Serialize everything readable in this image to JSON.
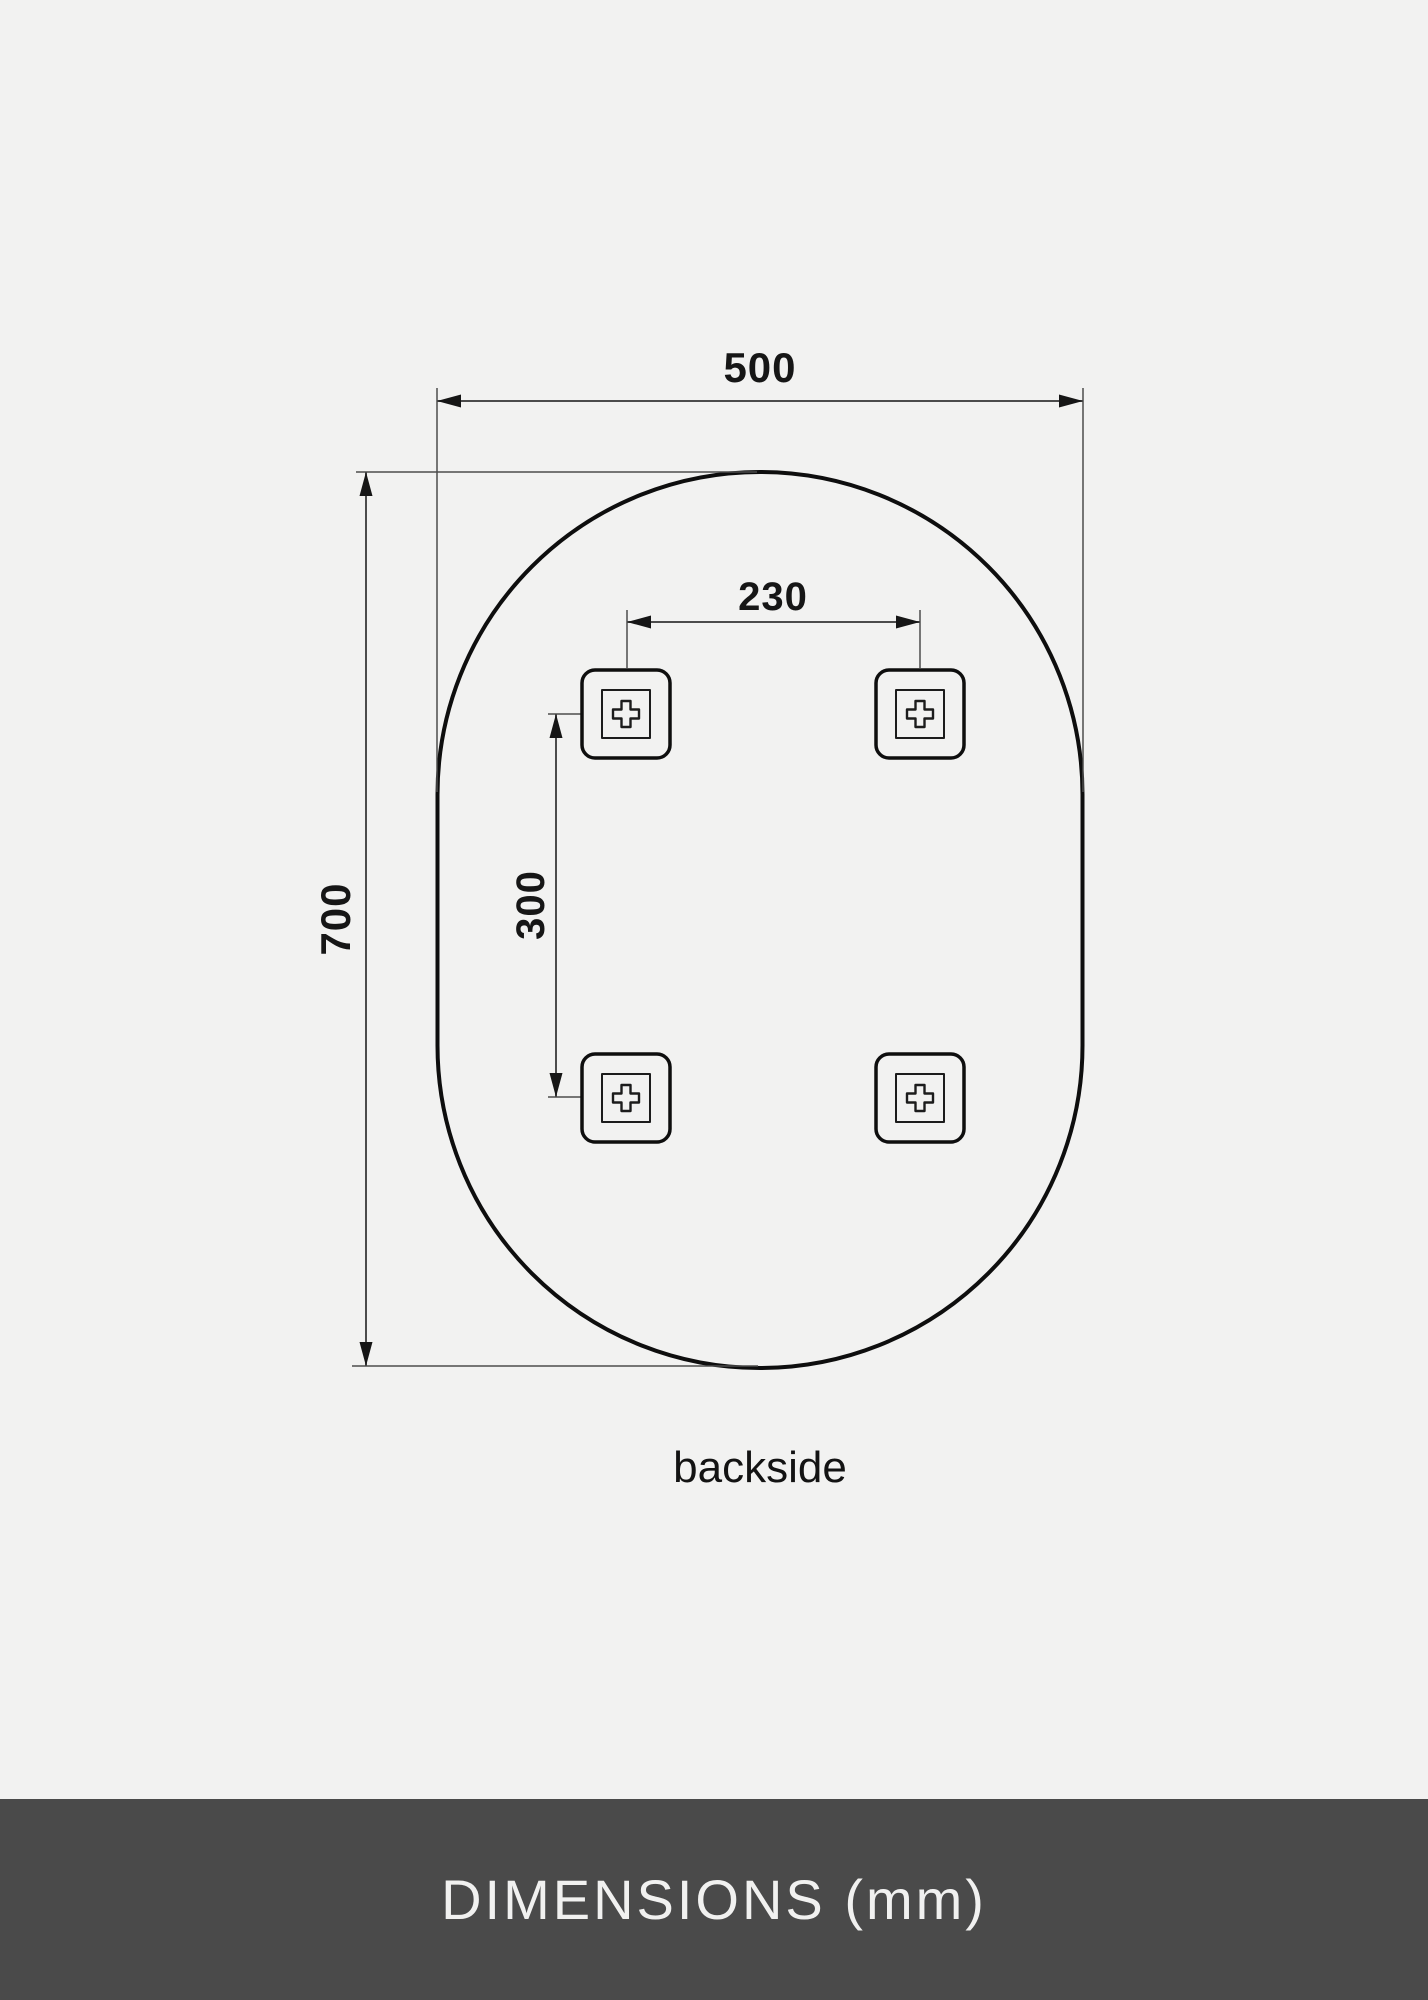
{
  "page": {
    "background_color": "#f2f2f1"
  },
  "diagram": {
    "caption": "backside",
    "dimensions": {
      "overall_width_mm": "500",
      "overall_height_mm": "700",
      "bracket_spacing_horizontal_mm": "230",
      "bracket_spacing_vertical_mm": "300"
    },
    "shape": "pill-oval mirror outline with 4 mounting brackets",
    "colors": {
      "outline": "#0e0e0e",
      "dimension_line": "#4c4c4c",
      "arrow_fill": "#161616",
      "label_text": "#161616"
    }
  },
  "footer": {
    "title": "DIMENSIONS (mm)",
    "background_color": "#4a4a4a",
    "text_color": "#f1f1f0"
  }
}
